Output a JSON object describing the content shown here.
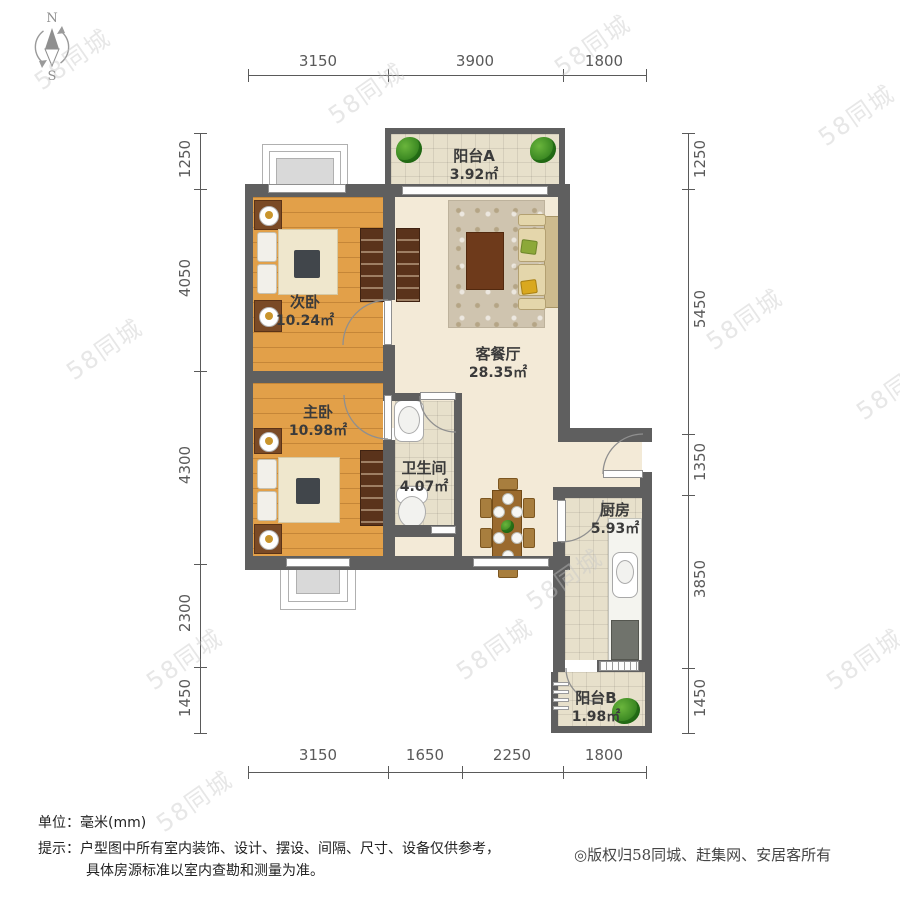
{
  "compass": {
    "north": "N",
    "south": "S"
  },
  "watermark": {
    "text": "58同城"
  },
  "rooms": [
    {
      "name": "阳台A",
      "area": "3.92㎡"
    },
    {
      "name": "次卧",
      "area": "10.24㎡"
    },
    {
      "name": "主卧",
      "area": "10.98㎡"
    },
    {
      "name": "客餐厅",
      "area": "28.35㎡"
    },
    {
      "name": "卫生间",
      "area": "4.07㎡"
    },
    {
      "name": "厨房",
      "area": "5.93㎡"
    },
    {
      "name": "阳台B",
      "area": "1.98㎡"
    }
  ],
  "dims": {
    "top": [
      "3150",
      "3900",
      "1800"
    ],
    "bottom": [
      "3150",
      "1650",
      "2250",
      "1800"
    ],
    "left": [
      "1250",
      "4050",
      "4300",
      "2300",
      "1450"
    ],
    "right": [
      "1250",
      "5450",
      "1350",
      "3850",
      "1450"
    ]
  },
  "footer": {
    "unit": "单位：毫米(mm)",
    "tip1": "提示：户型图中所有室内装饰、设计、摆设、间隔、尺寸、设备仅供参考，",
    "tip2": "具体房源标准以室内查勘和测量为准。",
    "copyright": "◎版权归58同城、赶集网、安居客所有"
  },
  "colors": {
    "wall": "#5f5f5f",
    "wood_floor": "#e2a049",
    "living_floor": "#f3ead7",
    "label_text": "#3b3b3b",
    "dimension_text": "#5a5a5a",
    "plant_green": "#3f9b2f",
    "watermark_gray": "#c7c7c7"
  }
}
